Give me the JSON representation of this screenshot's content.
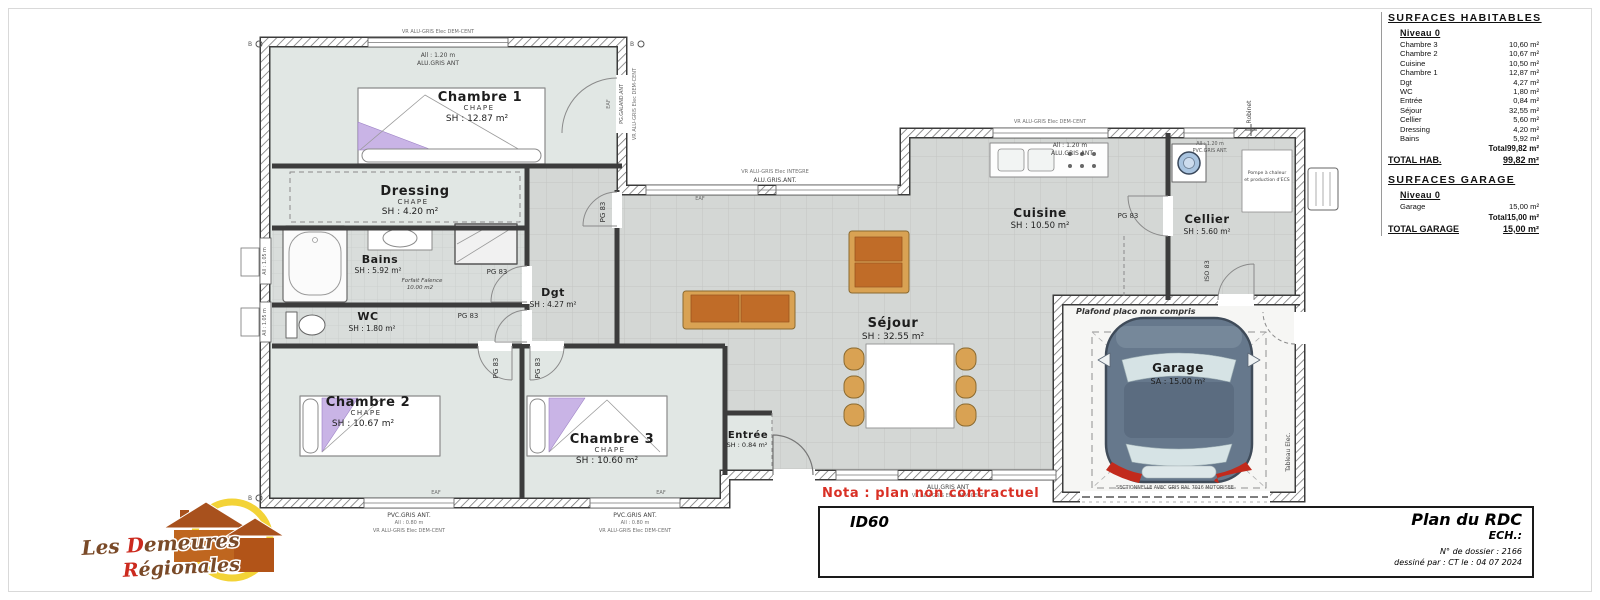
{
  "panel": {
    "hab_title": "SURFACES HABITABLES",
    "level": "Niveau 0",
    "rows": [
      {
        "label": "Chambre 3",
        "value": "10,60 m²"
      },
      {
        "label": "Chambre 2",
        "value": "10,67 m²"
      },
      {
        "label": "Cuisine",
        "value": "10,50 m²"
      },
      {
        "label": "Chambre 1",
        "value": "12,87 m²"
      },
      {
        "label": "Dgt",
        "value": "4,27 m²"
      },
      {
        "label": "WC",
        "value": "1,80 m²"
      },
      {
        "label": "Entrée",
        "value": "0,84 m²"
      },
      {
        "label": "Séjour",
        "value": "32,55 m²"
      },
      {
        "label": "Cellier",
        "value": "5,60 m²"
      },
      {
        "label": "Dressing",
        "value": "4,20 m²"
      },
      {
        "label": "Bains",
        "value": "5,92 m²"
      }
    ],
    "total_label": "Total",
    "total_value": "99,82 m²",
    "total_hab_label": "TOTAL HAB.",
    "total_hab_value": "99,82 m²",
    "garage_title": "SURFACES GARAGE",
    "garage_level": "Niveau 0",
    "garage_rows": [
      {
        "label": "Garage",
        "value": "15,00 m²"
      }
    ],
    "garage_total_label": "Total",
    "garage_total_value": "15,00 m²",
    "garage_grand_label": "TOTAL GARAGE",
    "garage_grand_value": "15,00 m²"
  },
  "titleblock": {
    "ref": "ID60",
    "title": "Plan du RDC",
    "scale": "ECH.:",
    "dossier": "N° de dossier : 2166",
    "drawn": "dessiné par : CT   le : 04 07 2024"
  },
  "nota": "Nota : plan non contractuel",
  "logo": {
    "l1a": "Les ",
    "l1b": "D",
    "l1c": "emeures",
    "l2a": "R",
    "l2b": "égionales"
  },
  "rooms": {
    "chambre1": {
      "name": "Chambre 1",
      "sub": "CHAPE",
      "area": "SH : 12.87 m²"
    },
    "dressing": {
      "name": "Dressing",
      "sub": "CHAPE",
      "area": "SH : 4.20 m²"
    },
    "bains": {
      "name": "Bains",
      "area": "SH : 5.92 m²",
      "note1": "Forfait Faïence",
      "note2": "10.00 m2"
    },
    "wc": {
      "name": "WC",
      "area": "SH : 1.80 m²"
    },
    "dgt": {
      "name": "Dgt",
      "area": "SH : 4.27 m²"
    },
    "chambre2": {
      "name": "Chambre 2",
      "sub": "CHAPE",
      "area": "SH : 10.67 m²"
    },
    "chambre3": {
      "name": "Chambre 3",
      "sub": "CHAPE",
      "area": "SH : 10.60 m²"
    },
    "entree": {
      "name": "Entrée",
      "area": "SH : 0.84 m²"
    },
    "sejour": {
      "name": "Séjour",
      "area": "SH : 32.55 m²"
    },
    "cuisine": {
      "name": "Cuisine",
      "area": "SH : 10.50 m²"
    },
    "cellier": {
      "name": "Cellier",
      "area": "SH : 5.60 m²"
    },
    "garage": {
      "name": "Garage",
      "area": "SA : 15.00 m²",
      "note": "Plafond placo non compris",
      "door": "SECTIONNELLE AVEC GRIS RAL 7016 MOTORISEE"
    }
  },
  "labels": {
    "pg83": "PG 83",
    "iso83": "ISO 83",
    "eaf": "EAF",
    "vr_demcent": "VR ALU-GRIS Elec DEM-CENT",
    "vr_integre": "VR ALU-GRIS Elec INTEGRE",
    "all_120": "All : 1.20 m",
    "all_080": "All : 0.80 m",
    "all_105": "All : 1.05 m",
    "alu_gris_ant": "ALU.GRIS ANT",
    "alu_gris_ant_dot": "ALU.GRIS.ANT.",
    "pvc_gris_ant": "PVC.GRIS ANT.",
    "galand": "PG.GALAND.ANT",
    "robinet": "Robinet",
    "tableau": "Tableau Elec.",
    "pompe1": "Pompe à chaleur",
    "pompe2": "et production d'ECS",
    "marker": "B"
  }
}
